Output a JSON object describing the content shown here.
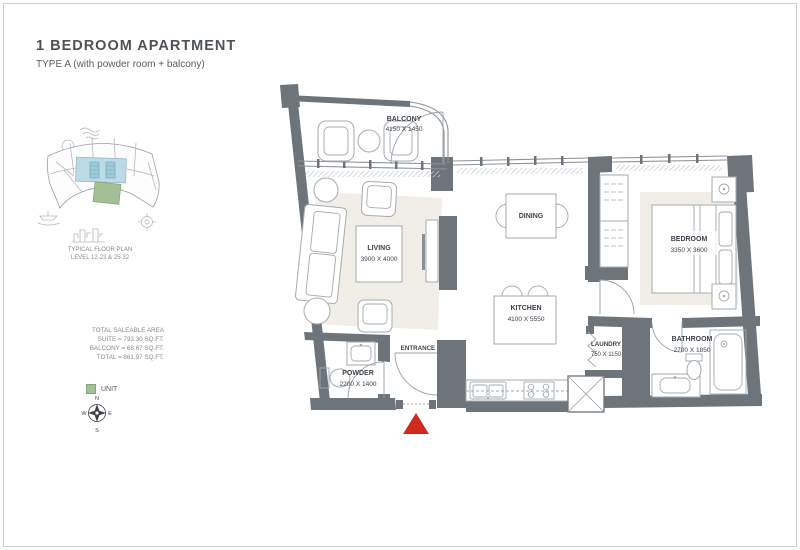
{
  "page": {
    "title": "1 BEDROOM APARTMENT",
    "subtitle": "TYPE A (with powder room + balcony)"
  },
  "key_plan": {
    "caption_line1": "TYPICAL FLOOR PLAN",
    "caption_line2": "LEVEL 12-23 & 25-32"
  },
  "areas": {
    "heading": "TOTAL SALEABLE AREA",
    "suite": "SUITE = 793.30 SQ.FT.",
    "balcony": "BALCONY = 68.67 SQ.FT.",
    "total": "TOTAL = 861.97 SQ.FT."
  },
  "legend": {
    "unit_label": "UNIT"
  },
  "compass": {
    "north": "N",
    "east": "E",
    "south": "S",
    "west": "W"
  },
  "plan": {
    "balcony": {
      "name": "BALCONY",
      "dims": "4150 X 1450"
    },
    "living": {
      "name": "LIVING",
      "dims": "3900 X 4000"
    },
    "dining": {
      "name": "DINING"
    },
    "kitchen": {
      "name": "KITCHEN",
      "dims": "4100 X 5550"
    },
    "bedroom": {
      "name": "BEDROOM",
      "dims": "3350 X 3600"
    },
    "laundry": {
      "name": "LAUNDRY",
      "dims": "750 X 1150"
    },
    "bathroom": {
      "name": "BATHROOM",
      "dims": "2700 X 1850"
    },
    "powder": {
      "name": "POWDER",
      "dims": "2200 X 1400"
    },
    "entrance": {
      "name": "ENTRANCE"
    }
  },
  "colors": {
    "wall": "#6d747a",
    "entry_marker_red": "#d02a20",
    "unit_green": "#a3bf96",
    "core_blue": "#bcdbe6",
    "label_text": "#3f444a"
  }
}
